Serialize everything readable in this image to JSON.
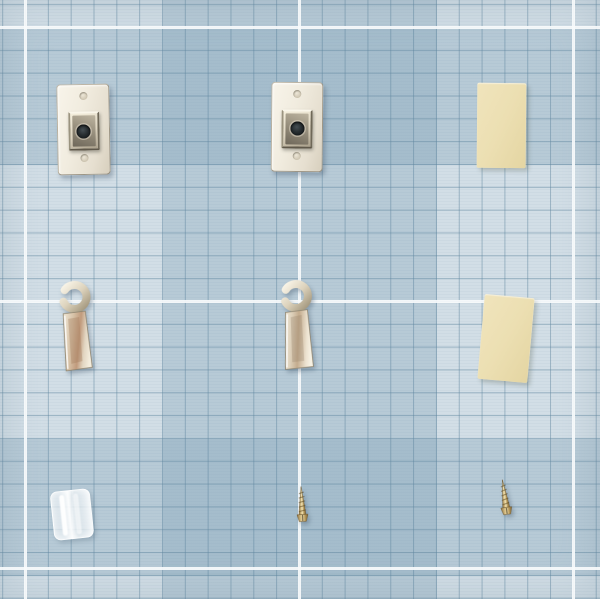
{
  "scene": {
    "description": "Flat-lay photo of picture-hanging hardware arranged on a pale blue gingham cutting-mat grid",
    "surface": "blue grid mat with white guide lines"
  },
  "palette": {
    "mat_light": "#d2dee6",
    "mat_band": "rgba(130,163,184,0.34)",
    "grid_line": "rgba(94,133,158,0.5)",
    "white_line": "rgba(248,251,252,0.92)",
    "nickel_light": "#f6f1e4",
    "nickel_mid": "#d8cfbb",
    "nickel_dark": "#9a8f77",
    "hole_dark": "#272d30",
    "pad_cream": "#ecdfb2",
    "brass_light": "#f2e6ba",
    "brass_mid": "#c8a968",
    "brass_dark": "#836a38",
    "plug_clear": "rgba(255,255,255,0.8)"
  },
  "background": {
    "white_vlines_x": [
      24,
      298,
      572
    ],
    "white_hlines_y": [
      26,
      300,
      567
    ],
    "fine_grid_cell_px": 22.83
  },
  "items": [
    {
      "id": "plate-1",
      "label": "keyhole hanger plate",
      "x": 57,
      "y": 84,
      "w": 51,
      "h": 89,
      "rot": -1
    },
    {
      "id": "plate-2",
      "label": "keyhole hanger plate",
      "x": 271,
      "y": 82,
      "w": 50,
      "h": 88,
      "rot": 0.5
    },
    {
      "id": "pad-1",
      "label": "adhesive foam pad",
      "x": 477,
      "y": 83,
      "w": 49,
      "h": 85,
      "rot": 0.5
    },
    {
      "id": "hook-1",
      "label": "metal cup hook",
      "x": 55,
      "y": 281,
      "w": 44,
      "h": 92,
      "rot": 1
    },
    {
      "id": "hook-2",
      "label": "metal cup hook",
      "x": 276,
      "y": 280,
      "w": 44,
      "h": 92,
      "rot": -2
    },
    {
      "id": "pad-2",
      "label": "adhesive foam pad",
      "x": 481,
      "y": 296,
      "w": 50,
      "h": 85,
      "rot": 5
    },
    {
      "id": "plug",
      "label": "clear plastic anchor",
      "x": 52,
      "y": 490,
      "w": 38,
      "h": 47,
      "rot": -6
    },
    {
      "id": "screw-1",
      "label": "brass screw",
      "x": 294,
      "y": 485,
      "w": 16,
      "h": 41,
      "rot": -3
    },
    {
      "id": "screw-2",
      "label": "brass screw",
      "x": 497,
      "y": 478,
      "w": 16,
      "h": 41,
      "rot": -8
    }
  ]
}
